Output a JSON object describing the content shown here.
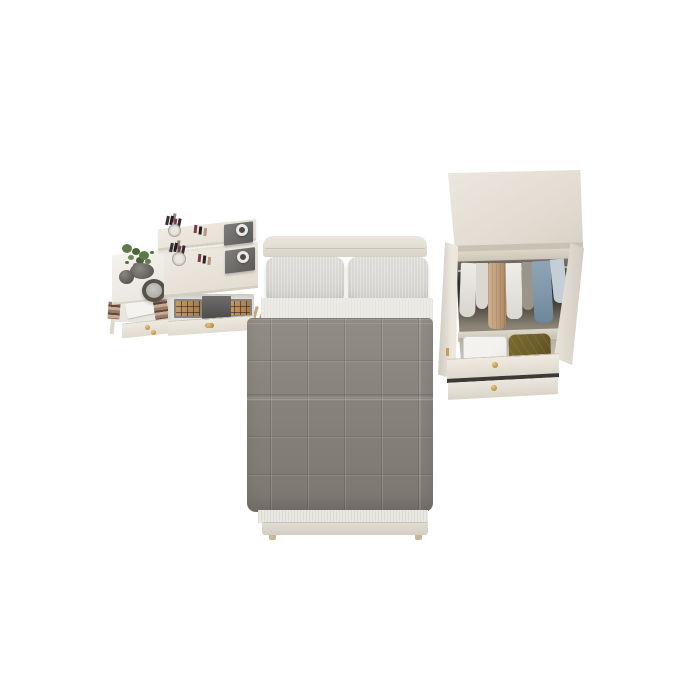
{
  "scene": {
    "description": "Top-down 3D product render of a bedroom furniture set on a plain white background",
    "background": "#ffffff",
    "colors": {
      "bg": "#ffffff",
      "cream": "#e2dcd2",
      "headboard": "#e4dfd6",
      "pillow": "#d7d6d2",
      "sheet": "#edebe6",
      "blanket": "#87827b",
      "blanket-light": "#918c85",
      "mattress": "#e9e8e3",
      "interior-dark": "#2e2a25",
      "clothes-gray": "#9a948b",
      "tan": "#c2a07f",
      "denim": "#7f97aa",
      "skyblue": "#c3ced7",
      "olive": "#6d5e2b",
      "gold": "#c79e52",
      "plant-green": "#5d7b4a",
      "palette-amber": "#c59a68",
      "wood": "#c9a577",
      "suitcase": "#f2f1ee"
    }
  },
  "furniture": {
    "vanity": {
      "label": "Dressing table with raised shelf, makeup brushes, lipsticks, jewelry trays, plant, round mirror and open drawers with eyeshadow palettes",
      "items": [
        "makeup brush cup",
        "lipsticks",
        "jewelry tray with jar",
        "potted plant",
        "decor vase",
        "round mirror",
        "perfume box",
        "eyeshadow palettes",
        "dark storage box",
        "drawers with gold knobs",
        "wooden legs"
      ]
    },
    "bed": {
      "label": "Single bed with cream headboard, two linen pillows, white sheet and gray quilted blanket",
      "items": [
        "headboard",
        "left pillow",
        "right pillow",
        "sheet",
        "quilted blanket",
        "mattress edge",
        "footboard",
        "feet"
      ]
    },
    "wardrobe": {
      "label": "Open wardrobe with top shelf boxes, hanging clothes rail, suitcase, olive cushion and two drawers with gold knobs",
      "items": [
        "top panel",
        "storage boxes",
        "folded clothes",
        "hanging rail",
        "white garments",
        "tan coat",
        "gray garment",
        "denim jacket",
        "light blue shirt",
        "dark bag",
        "suitcase",
        "olive cushion",
        "two drawers"
      ]
    }
  }
}
